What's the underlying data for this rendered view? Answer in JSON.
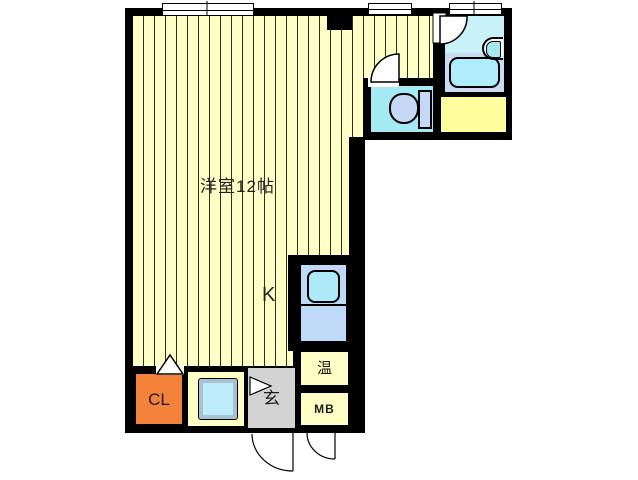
{
  "floorplan": {
    "type": "apartment-floor-plan",
    "labels": {
      "main_room": "洋室12帖",
      "kitchen": "K",
      "water_heater": "温",
      "meter_box": "MB",
      "closet": "CL",
      "entrance": "玄"
    },
    "rooms": [
      {
        "name": "western-room",
        "label": "洋室12帖",
        "floor": "striped pale yellow"
      },
      {
        "name": "kitchen-area",
        "label": "K"
      },
      {
        "name": "toilet-room",
        "label": ""
      },
      {
        "name": "bathroom",
        "label": ""
      },
      {
        "name": "service-room",
        "label": ""
      },
      {
        "name": "water-heater-box",
        "label": "温"
      },
      {
        "name": "meter-box",
        "label": "MB"
      },
      {
        "name": "closet",
        "label": "CL"
      },
      {
        "name": "washer-bay",
        "label": ""
      },
      {
        "name": "entrance-hall",
        "label": "玄"
      }
    ],
    "fixtures": [
      "bathtub",
      "wash-basin",
      "toilet",
      "kitchen-sink",
      "washing-machine-pan",
      "entrance-door",
      "meter-box-door",
      "bathroom-door",
      "toilet-door",
      "window",
      "window",
      "window",
      "pillar"
    ],
    "colors": {
      "wall": "#000000",
      "striped_floor": "#ffffc6",
      "stripe_line": "#2e2e20",
      "toilet_floor": "#a5eaf2",
      "bath_floor": "#c9f1f8",
      "bath_pad": "#c9dcf2",
      "bathtub": "#b0edfa",
      "service_room": "#ffff9e",
      "kitchen_unit": "#bfd9f8",
      "kitchen_sink": "#adeaf8",
      "closet": "#f5823a",
      "entrance": "#d3d3d3",
      "utility_box": "#ffffc6",
      "washer_pan": "#beecfa",
      "washer_frame": "#a9c2d2",
      "fixture_fill": "#c5d9f6"
    }
  }
}
